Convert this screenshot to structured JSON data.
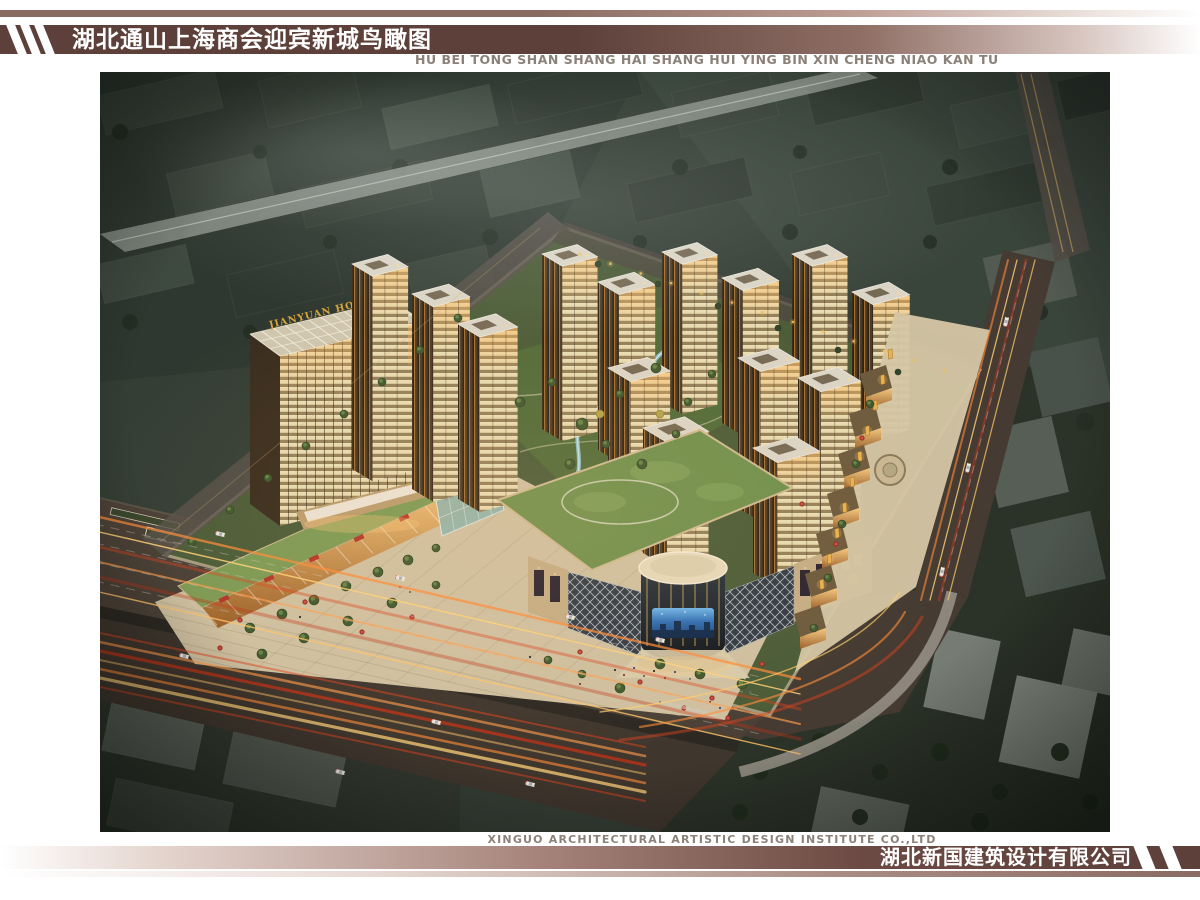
{
  "header": {
    "title": "湖北通山上海商会迎宾新城鸟瞰图",
    "subtitle": "HU BEI TONG SHAN SHANG HAI SHANG HUI YING BIN XIN CHENG NIAO KAN TU"
  },
  "footer": {
    "company_en": "XINGUO ARCHITECTURAL ARTISTIC DESIGN INSTITUTE CO.,LTD",
    "company_cn": "湖北新国建筑设计有限公司"
  },
  "rendering": {
    "hotel_sign": "JIANYUAN HOTEL",
    "description": "Night-time aerial bird's-eye rendering of Yingbin New City: rows of lit high-rise residential towers, a hotel tower with rooftop trellis, street-front commercial blocks, a circular glass shopping atrium with LED screen, landscaped gardens, and boulevards with car light trails surrounded by a dark city context."
  },
  "colors": {
    "band_dark": "#5d403a",
    "band_thin": "#8a6b62",
    "stripe_white": "#ffffff",
    "subtitle_gray": "#8b8178",
    "title_white": "#ffffff"
  }
}
